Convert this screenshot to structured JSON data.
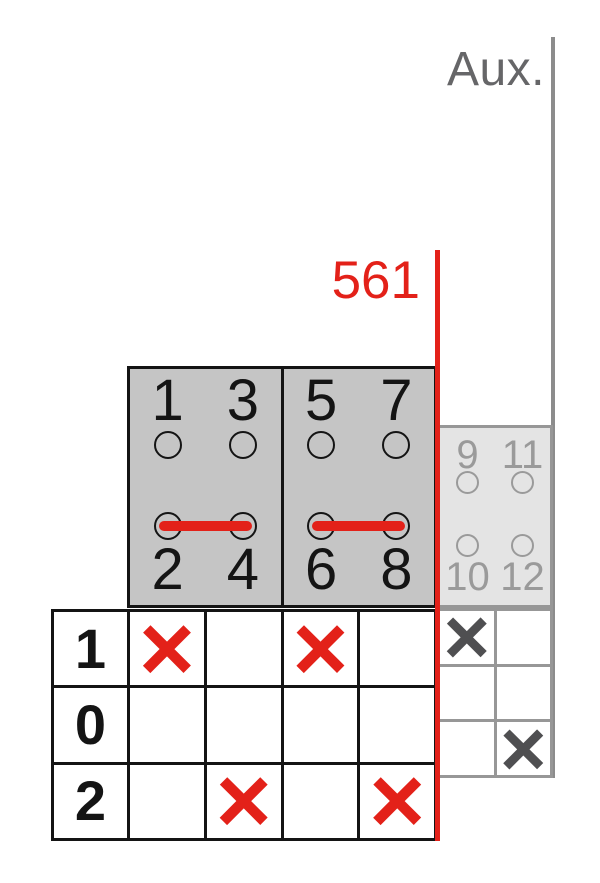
{
  "labels": {
    "aux": "Aux.",
    "switch_type": "561"
  },
  "colors": {
    "red_accent": "#e32119",
    "main_box_fill": "#c5c5c5",
    "aux_box_fill": "#e4e4e4",
    "aux_gray": "#9a9a9a",
    "aux_label_gray": "#666668",
    "aux_mark_gray": "#4f4f51",
    "black": "#141414"
  },
  "main_switch": {
    "poles": [
      {
        "terminals": {
          "top_left": "1",
          "top_right": "3",
          "bottom_left": "2",
          "bottom_right": "4"
        },
        "bridge_top": false,
        "bridge_bottom": true
      },
      {
        "terminals": {
          "top_left": "5",
          "top_right": "7",
          "bottom_left": "6",
          "bottom_right": "8"
        },
        "bridge_top": false,
        "bridge_bottom": true
      }
    ]
  },
  "aux_switch": {
    "terminals": {
      "top_left": "9",
      "top_right": "11",
      "bottom_left": "10",
      "bottom_right": "12"
    },
    "bridge_top": false,
    "bridge_bottom": false
  },
  "state_table": {
    "row_labels": [
      "1",
      "0",
      "2"
    ],
    "marks": [
      [
        "×",
        "",
        "×",
        ""
      ],
      [
        "",
        "",
        "",
        ""
      ],
      [
        "",
        "×",
        "",
        "×"
      ]
    ]
  },
  "aux_state_table": {
    "marks": [
      [
        "×",
        ""
      ],
      [
        "",
        ""
      ],
      [
        "",
        "×"
      ]
    ]
  }
}
